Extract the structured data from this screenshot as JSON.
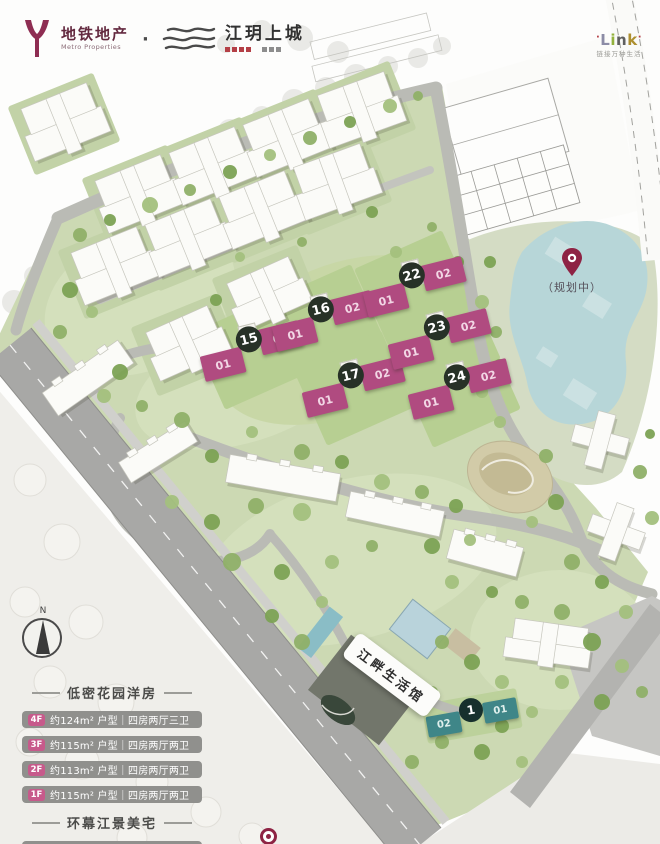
{
  "header": {
    "brand1_name": "地铁地产",
    "brand1_sub": "Metro Properties",
    "separator": "·",
    "brand2_name": "江玥上城",
    "brand3_dot": "·",
    "brand3_letters": [
      "L",
      "i",
      "n",
      "k"
    ],
    "brand3_sub": "链接万种生活"
  },
  "map": {
    "planned_label": "（规划中）",
    "pavilion_label": "江畔生活馆",
    "compass_n": "N",
    "buildings": [
      {
        "num": "15",
        "left": "01",
        "right": "02"
      },
      {
        "num": "16",
        "left": "01",
        "right": "02"
      },
      {
        "num": "17",
        "left": "01",
        "right": "02"
      },
      {
        "num": "22",
        "left": "01",
        "right": "02"
      },
      {
        "num": "23",
        "left": "01",
        "right": "02"
      },
      {
        "num": "24",
        "left": "01",
        "right": "02"
      },
      {
        "num": "1",
        "left": "02",
        "right": "01"
      }
    ]
  },
  "legend": {
    "section1_title": "低密花园洋房",
    "rows": [
      {
        "badge": "4F",
        "text": "约124m² 户型｜四房两厅三卫"
      },
      {
        "badge": "3F",
        "text": "约115m² 户型｜四房两厅两卫"
      },
      {
        "badge": "2F",
        "text": "约113m² 户型｜四房两厅两卫"
      },
      {
        "badge": "1F",
        "text": "约115m² 户型｜四房两厅两卫"
      }
    ],
    "section2_title": "环幕江景美宅",
    "row5": {
      "badge": "",
      "text": "约139m² 户型｜四房三厅两卫"
    }
  },
  "colors": {
    "highlight_magenta": "#b04b80",
    "highlight_teal": "#3f8688",
    "badge_dark": "#273127",
    "brand_maroon": "#8e2d52",
    "lake_blue": "#b7d6d8",
    "legend_row_gray": "#90908d"
  }
}
